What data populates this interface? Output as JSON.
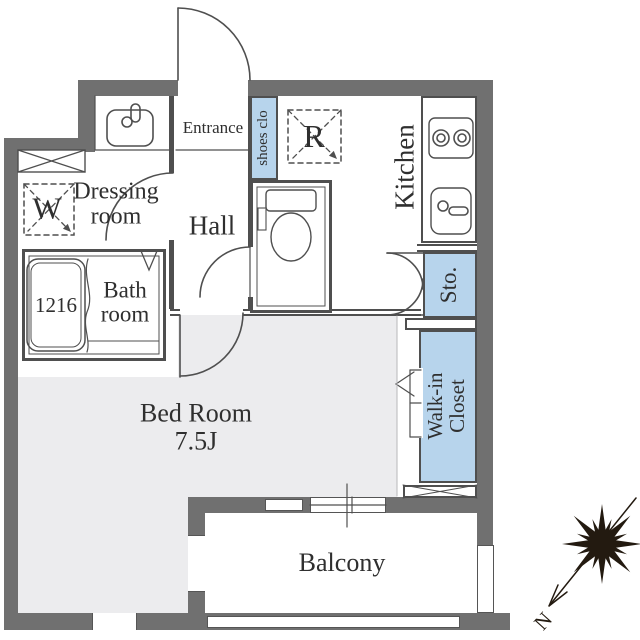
{
  "colors": {
    "wall": "#707070",
    "line": "#4f4f4f",
    "floor": "#ececee",
    "closet_fill": "#b7d4ec",
    "text": "#2f2f2f",
    "compass": "#231a10"
  },
  "labels": {
    "entrance": "Entrance",
    "shoes_closet": "shoes clo",
    "refrigerator": "R",
    "kitchen": "Kitchen",
    "dressing_room": "Dressing room",
    "washer": "W",
    "hall": "Hall",
    "bathroom": "Bath room",
    "bathtub_size": "1216",
    "storage": "Sto.",
    "bedroom": "Bed Room",
    "bedroom_size": "7.5J",
    "walk_in_closet": "Walk-in Closet",
    "balcony": "Balcony",
    "compass_north": "N"
  }
}
